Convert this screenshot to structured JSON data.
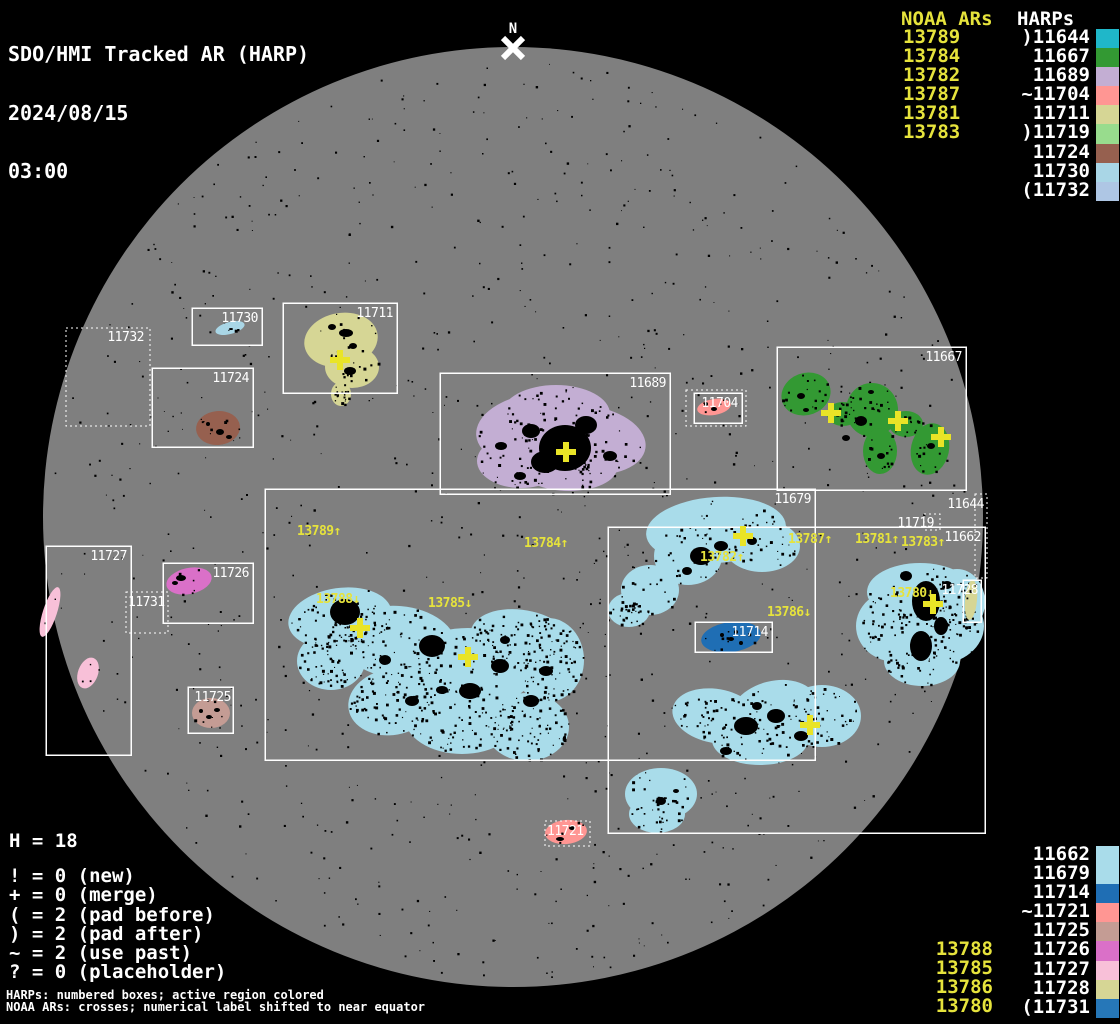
{
  "header": {
    "title": "SDO/HMI Tracked AR (HARP)",
    "date": "2024/08/15",
    "time": "03:00"
  },
  "north": {
    "label": "N"
  },
  "legend_top": {
    "noaa_header": "NOAA ARs",
    "harps_header": "HARPs",
    "noaa": [
      "13789",
      "13784",
      "13782",
      "13787",
      "13781",
      "13783"
    ],
    "harps": [
      {
        "label": ")11644",
        "color": "#1fb7c9"
      },
      {
        "label": "11667",
        "color": "#339933"
      },
      {
        "label": "11689",
        "color": "#c3aed3"
      },
      {
        "label": "~11704",
        "color": "#ff9693"
      },
      {
        "label": "11711",
        "color": "#d6d695"
      },
      {
        "label": ")11719",
        "color": "#98dc8d"
      },
      {
        "label": "11724",
        "color": "#96604f"
      },
      {
        "label": "11730",
        "color": "#a9d6e6"
      },
      {
        "label": "(11732",
        "color": "#aec6e4"
      }
    ]
  },
  "legend_bottom": {
    "harps": [
      {
        "label": "11662",
        "color": "#a9dcea"
      },
      {
        "label": "11679",
        "color": "#a9dcea"
      },
      {
        "label": "11714",
        "color": "#1f6eb4"
      },
      {
        "label": "~11721",
        "color": "#ff9693"
      },
      {
        "label": "11725",
        "color": "#c49c94"
      },
      {
        "label": "11726",
        "color": "#da70c8"
      },
      {
        "label": "11727",
        "color": "#f8c0d8"
      },
      {
        "label": "11728",
        "color": "#d6d695"
      },
      {
        "label": "(11731",
        "color": "#2677b8"
      }
    ],
    "noaa": [
      "13788",
      "13785",
      "13786",
      "13780"
    ]
  },
  "stats": {
    "h_line": "H = 18"
  },
  "symbol_legend": [
    "! = 0 (new)",
    "+ = 0 (merge)",
    "( = 2 (pad before)",
    ") = 2 (pad after)",
    "~ = 2 (use past)",
    "? = 0 (placeholder)"
  ],
  "footnotes": [
    "HARPs: numbered boxes; active region colored",
    "NOAA ARs: crosses; numerical label shifted to near equator"
  ],
  "chart_data": {
    "type": "map",
    "title": "SDO/HMI Tracked AR (HARP) 2024/08/15 03:00",
    "disk": {
      "cx": 513,
      "cy": 517,
      "r": 470,
      "color": "#7f7f7f",
      "background": "#000000"
    },
    "colors": {
      "box": "#ffffff",
      "noaa_label": "#e6e33c",
      "cross": "#e9e427",
      "speckle": "#000000"
    },
    "boxes": [
      {
        "label": "11732",
        "x": 66,
        "y": 328,
        "w": 84,
        "h": 98,
        "style": "dotted",
        "lx": 144,
        "ly": 341,
        "anchor": "end"
      },
      {
        "label": "11730",
        "x": 192,
        "y": 308,
        "w": 70,
        "h": 37,
        "style": "solid",
        "lx": 258,
        "ly": 322,
        "anchor": "end"
      },
      {
        "label": "11711",
        "x": 283,
        "y": 303,
        "w": 114,
        "h": 90,
        "style": "solid",
        "lx": 393,
        "ly": 317,
        "anchor": "end"
      },
      {
        "label": "11724",
        "x": 152,
        "y": 368,
        "w": 101,
        "h": 79,
        "style": "solid",
        "lx": 249,
        "ly": 382,
        "anchor": "end"
      },
      {
        "label": "11689",
        "x": 440,
        "y": 373,
        "w": 230,
        "h": 121,
        "style": "solid",
        "lx": 666,
        "ly": 387,
        "anchor": "end"
      },
      {
        "label": "",
        "x": 686,
        "y": 390,
        "w": 60,
        "h": 36,
        "style": "dotted",
        "lx": 0,
        "ly": 0,
        "anchor": "end"
      },
      {
        "label": "11704",
        "x": 694,
        "y": 393,
        "w": 48,
        "h": 30,
        "style": "solid",
        "lx": 738,
        "ly": 407,
        "anchor": "end"
      },
      {
        "label": "11667",
        "x": 777,
        "y": 347,
        "w": 189,
        "h": 143,
        "style": "solid",
        "lx": 962,
        "ly": 361,
        "anchor": "end"
      },
      {
        "label": "11679",
        "x": 265,
        "y": 489,
        "w": 550,
        "h": 271,
        "style": "solid",
        "lx": 811,
        "ly": 503,
        "anchor": "end"
      },
      {
        "label": "11662",
        "x": 608,
        "y": 527,
        "w": 377,
        "h": 306,
        "style": "solid",
        "lx": 981,
        "ly": 541,
        "anchor": "end"
      },
      {
        "label": "11719",
        "x": 924,
        "y": 514,
        "w": 16,
        "h": 16,
        "style": "dotted",
        "lx": 934,
        "ly": 527,
        "anchor": "end"
      },
      {
        "label": "11644",
        "x": 975,
        "y": 494,
        "w": 12,
        "h": 84,
        "style": "dotted",
        "lx": 984,
        "ly": 508,
        "anchor": "end"
      },
      {
        "label": "11727",
        "x": 46,
        "y": 546,
        "w": 85,
        "h": 209,
        "style": "solid",
        "lx": 127,
        "ly": 560,
        "anchor": "end"
      },
      {
        "label": "11726",
        "x": 163,
        "y": 563,
        "w": 90,
        "h": 60,
        "style": "solid",
        "lx": 249,
        "ly": 577,
        "anchor": "end"
      },
      {
        "label": "11731",
        "x": 126,
        "y": 592,
        "w": 42,
        "h": 41,
        "style": "dotted",
        "lx": 128,
        "ly": 606,
        "anchor": "start"
      },
      {
        "label": "11725",
        "x": 188,
        "y": 687,
        "w": 45,
        "h": 46,
        "style": "solid",
        "lx": 231,
        "ly": 701,
        "anchor": "end"
      },
      {
        "label": "11714",
        "x": 695,
        "y": 622,
        "w": 77,
        "h": 30,
        "style": "solid",
        "lx": 768,
        "ly": 636,
        "anchor": "end"
      },
      {
        "label": "11728",
        "x": 963,
        "y": 580,
        "w": 18,
        "h": 42,
        "style": "solid",
        "lx": 978,
        "ly": 594,
        "anchor": "end"
      },
      {
        "label": "11721",
        "x": 545,
        "y": 821,
        "w": 45,
        "h": 25,
        "style": "dotted",
        "lx": 547,
        "ly": 835,
        "anchor": "start"
      }
    ],
    "noaa_labels": [
      {
        "text": "13789↑",
        "x": 297,
        "y": 535
      },
      {
        "text": "13784↑",
        "x": 524,
        "y": 547
      },
      {
        "text": "13782↑",
        "x": 700,
        "y": 561
      },
      {
        "text": "13787↑",
        "x": 788,
        "y": 543
      },
      {
        "text": "13781↑",
        "x": 855,
        "y": 543
      },
      {
        "text": "13783↑",
        "x": 901,
        "y": 546
      },
      {
        "text": "13788↓",
        "x": 316,
        "y": 603
      },
      {
        "text": "13785↓",
        "x": 428,
        "y": 607
      },
      {
        "text": "13786↓",
        "x": 767,
        "y": 616
      },
      {
        "text": "13780↓",
        "x": 890,
        "y": 597
      }
    ],
    "crosses": [
      {
        "x": 340,
        "y": 360
      },
      {
        "x": 566,
        "y": 452
      },
      {
        "x": 831,
        "y": 413
      },
      {
        "x": 898,
        "y": 421
      },
      {
        "x": 941,
        "y": 437
      },
      {
        "x": 743,
        "y": 536
      },
      {
        "x": 360,
        "y": 628
      },
      {
        "x": 468,
        "y": 657
      },
      {
        "x": 810,
        "y": 725
      },
      {
        "x": 933,
        "y": 604
      }
    ],
    "regions": [
      {
        "name": "region-11679-main",
        "color": "#a9dcea",
        "speckles": 650,
        "ellipses": [
          [
            340,
            618,
            52,
            30,
            -8
          ],
          [
            398,
            642,
            58,
            36,
            5
          ],
          [
            468,
            668,
            68,
            40,
            0
          ],
          [
            522,
            640,
            52,
            30,
            10
          ],
          [
            548,
            660,
            36,
            42,
            0
          ],
          [
            462,
            716,
            58,
            38,
            0
          ],
          [
            392,
            702,
            44,
            33,
            -10
          ],
          [
            331,
            661,
            34,
            29,
            0
          ],
          [
            527,
            727,
            42,
            34,
            0
          ]
        ]
      },
      {
        "name": "region-11679-upper",
        "color": "#a9dcea",
        "speckles": 130,
        "ellipses": [
          [
            716,
            530,
            70,
            33,
            -4
          ],
          [
            762,
            546,
            38,
            26,
            0
          ],
          [
            688,
            556,
            34,
            29,
            0
          ],
          [
            650,
            590,
            29,
            25,
            0
          ],
          [
            629,
            610,
            21,
            17,
            0
          ]
        ]
      },
      {
        "name": "region-11679-lower",
        "color": "#a9dcea",
        "speckles": 170,
        "ellipses": [
          [
            716,
            716,
            44,
            27,
            10
          ],
          [
            774,
            710,
            44,
            29,
            -14
          ],
          [
            822,
            716,
            39,
            31,
            0
          ],
          [
            760,
            740,
            48,
            25,
            0
          ]
        ]
      },
      {
        "name": "region-11679-south",
        "color": "#a9dcea",
        "speckles": 45,
        "ellipses": [
          [
            661,
            794,
            36,
            26,
            0
          ],
          [
            657,
            814,
            28,
            19,
            0
          ]
        ]
      },
      {
        "name": "region-11662",
        "color": "#a9dcea",
        "speckles": 210,
        "ellipses": [
          [
            920,
            592,
            53,
            29,
            0
          ],
          [
            938,
            626,
            46,
            38,
            0
          ],
          [
            896,
            626,
            40,
            36,
            0
          ],
          [
            922,
            661,
            38,
            25,
            0
          ],
          [
            957,
            602,
            28,
            33,
            0
          ]
        ]
      },
      {
        "name": "region-11689",
        "color": "#c3aed3",
        "speckles": 160,
        "ellipses": [
          [
            540,
            430,
            64,
            37,
            -5
          ],
          [
            588,
            440,
            58,
            34,
            8
          ],
          [
            521,
            461,
            44,
            27,
            0
          ],
          [
            569,
            468,
            48,
            23,
            0
          ],
          [
            556,
            414,
            54,
            29,
            0
          ]
        ]
      },
      {
        "name": "region-11711",
        "color": "#d6d695",
        "speckles": 45,
        "ellipses": [
          [
            341,
            340,
            37,
            27,
            -10
          ],
          [
            352,
            367,
            27,
            21,
            0
          ],
          [
            341,
            394,
            10,
            12,
            0
          ]
        ]
      },
      {
        "name": "region-11667",
        "color": "#339933",
        "speckles": 90,
        "ellipses": [
          [
            806,
            394,
            25,
            21,
            -20
          ],
          [
            843,
            414,
            16,
            12,
            0
          ],
          [
            872,
            410,
            26,
            27,
            0
          ],
          [
            880,
            451,
            17,
            23,
            0
          ],
          [
            930,
            449,
            19,
            26,
            12
          ],
          [
            906,
            424,
            17,
            13,
            0
          ]
        ]
      },
      {
        "name": "region-11704",
        "color": "#ff9693",
        "speckles": 4,
        "ellipses": [
          [
            714,
            407,
            17,
            8,
            -10
          ]
        ]
      },
      {
        "name": "region-11730",
        "color": "#a9d6e6",
        "speckles": 3,
        "ellipses": [
          [
            230,
            328,
            15,
            6,
            -15
          ]
        ]
      },
      {
        "name": "region-11724",
        "color": "#96604f",
        "speckles": 8,
        "ellipses": [
          [
            218,
            428,
            22,
            17,
            -5
          ]
        ]
      },
      {
        "name": "region-11726",
        "color": "#da70c8",
        "speckles": 6,
        "ellipses": [
          [
            189,
            581,
            23,
            13,
            -12
          ]
        ]
      },
      {
        "name": "region-11727-a",
        "color": "#f8c0d8",
        "speckles": 2,
        "ellipses": [
          [
            50,
            612,
            7,
            26,
            18
          ]
        ]
      },
      {
        "name": "region-11727-b",
        "color": "#f8c0d8",
        "speckles": 4,
        "ellipses": [
          [
            88,
            673,
            10,
            16,
            20
          ]
        ]
      },
      {
        "name": "region-11725",
        "color": "#c49c94",
        "speckles": 7,
        "ellipses": [
          [
            211,
            713,
            19,
            15,
            0
          ]
        ]
      },
      {
        "name": "region-11714",
        "color": "#1f6eb4",
        "speckles": 10,
        "ellipses": [
          [
            731,
            637,
            30,
            15,
            -8
          ]
        ]
      },
      {
        "name": "region-11721",
        "color": "#ff9693",
        "speckles": 5,
        "ellipses": [
          [
            566,
            832,
            21,
            12,
            -5
          ]
        ]
      },
      {
        "name": "region-11728",
        "color": "#d6d695",
        "speckles": 3,
        "ellipses": [
          [
            971,
            600,
            6,
            20,
            5
          ]
        ]
      }
    ],
    "sunspots": [
      [
        565,
        448,
        26,
        23
      ],
      [
        545,
        462,
        14,
        11
      ],
      [
        586,
        425,
        11,
        9
      ],
      [
        531,
        431,
        9,
        7
      ],
      [
        610,
        456,
        7,
        5
      ],
      [
        501,
        446,
        6,
        4
      ],
      [
        520,
        476,
        6,
        4
      ],
      [
        345,
        612,
        15,
        13
      ],
      [
        432,
        646,
        13,
        11
      ],
      [
        500,
        666,
        9,
        7
      ],
      [
        470,
        691,
        11,
        8
      ],
      [
        531,
        701,
        8,
        6
      ],
      [
        412,
        701,
        7,
        5
      ],
      [
        546,
        671,
        7,
        5
      ],
      [
        385,
        660,
        6,
        5
      ],
      [
        442,
        690,
        6,
        4
      ],
      [
        505,
        640,
        5,
        4
      ],
      [
        701,
        556,
        11,
        9
      ],
      [
        721,
        546,
        7,
        5
      ],
      [
        752,
        541,
        5,
        4
      ],
      [
        687,
        571,
        5,
        4
      ],
      [
        746,
        726,
        12,
        9
      ],
      [
        776,
        716,
        9,
        7
      ],
      [
        801,
        736,
        7,
        5
      ],
      [
        726,
        751,
        6,
        4
      ],
      [
        757,
        706,
        5,
        4
      ],
      [
        926,
        601,
        14,
        20
      ],
      [
        921,
        646,
        11,
        15
      ],
      [
        941,
        626,
        7,
        9
      ],
      [
        906,
        576,
        6,
        5
      ],
      [
        947,
        585,
        5,
        4
      ],
      [
        346,
        333,
        7,
        4
      ],
      [
        353,
        346,
        4,
        3
      ],
      [
        350,
        371,
        6,
        4
      ],
      [
        332,
        327,
        4,
        3
      ],
      [
        801,
        396,
        4,
        3
      ],
      [
        861,
        421,
        6,
        5
      ],
      [
        881,
        456,
        4,
        3
      ],
      [
        931,
        446,
        4,
        3
      ],
      [
        846,
        438,
        4,
        3
      ],
      [
        806,
        410,
        3,
        2
      ],
      [
        871,
        392,
        3,
        2
      ],
      [
        220,
        432,
        4,
        3
      ],
      [
        229,
        437,
        3,
        2
      ],
      [
        208,
        424,
        2,
        2
      ],
      [
        181,
        578,
        5,
        3
      ],
      [
        175,
        583,
        3,
        2
      ],
      [
        209,
        717,
        3,
        2
      ],
      [
        217,
        710,
        3,
        2
      ],
      [
        201,
        711,
        2,
        2
      ],
      [
        731,
        639,
        3,
        2
      ],
      [
        741,
        643,
        2,
        2
      ],
      [
        722,
        635,
        2,
        2
      ],
      [
        736,
        632,
        2,
        2
      ],
      [
        560,
        839,
        4,
        2
      ],
      [
        572,
        828,
        3,
        2
      ],
      [
        661,
        801,
        5,
        4
      ],
      [
        676,
        791,
        3,
        2
      ],
      [
        714,
        409,
        3,
        2
      ],
      [
        706,
        404,
        2,
        2
      ],
      [
        231,
        329,
        2,
        1
      ]
    ]
  }
}
